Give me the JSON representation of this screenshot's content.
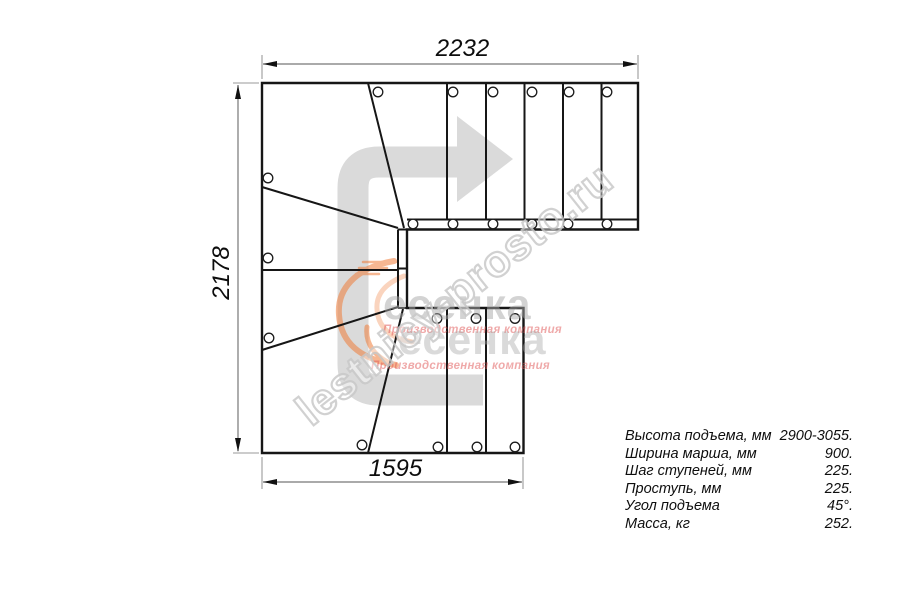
{
  "plan": {
    "dim_top": "2232",
    "dim_left": "2178",
    "dim_bottom": "1595"
  },
  "specs": {
    "rows": [
      {
        "label": "Высота подъема, мм",
        "value": "2900-3055."
      },
      {
        "label": "Ширина марша, мм",
        "value": "900."
      },
      {
        "label": "Шаг ступеней, мм",
        "value": "225."
      },
      {
        "label": "Проступь, мм",
        "value": "225."
      },
      {
        "label": "Угол подъема",
        "value": "45°."
      },
      {
        "label": "Масса, кг",
        "value": "252."
      }
    ]
  },
  "watermark": {
    "site": "lestnicy-prosto.ru",
    "logo_text": "есенка",
    "logo_subtitle": "Производственная компания"
  },
  "colors": {
    "drawing_line": "#161616",
    "dimension_line": "#7a7a7a",
    "arrow_fill": "#dadada",
    "watermark_outline": "#c9c9c9",
    "logo_gray": "#a9a9a9",
    "logo_red": "#e05555",
    "logo_orange": "#ef7d3a"
  }
}
